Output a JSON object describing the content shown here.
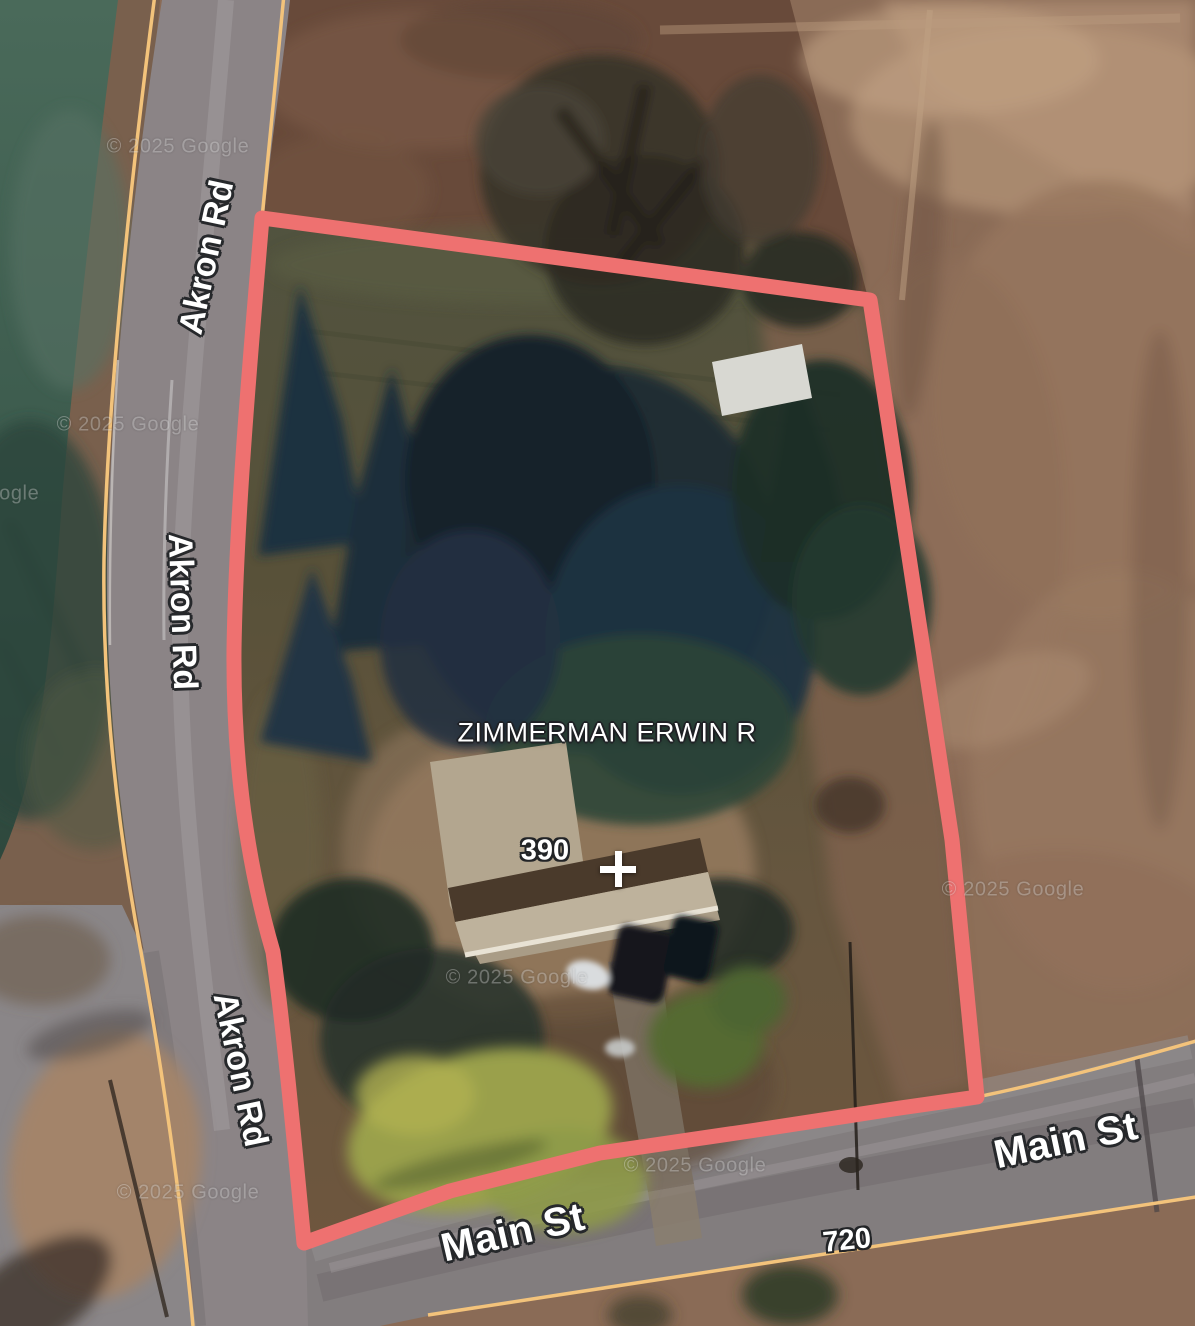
{
  "map": {
    "labels": {
      "owner": "ZIMMERMAN ERWIN R",
      "parcel_address": "390",
      "neighbor_address": "720",
      "akron_road": "Akron Rd",
      "main_street": "Main St",
      "watermark": "© 2025 Google",
      "crosshair_marker": "+"
    },
    "colors": {
      "parcel_boundary": "#ee7170",
      "parcel_line": "#f3c37b",
      "label_text": "#ffffff",
      "label_casing": "#26282b"
    }
  }
}
